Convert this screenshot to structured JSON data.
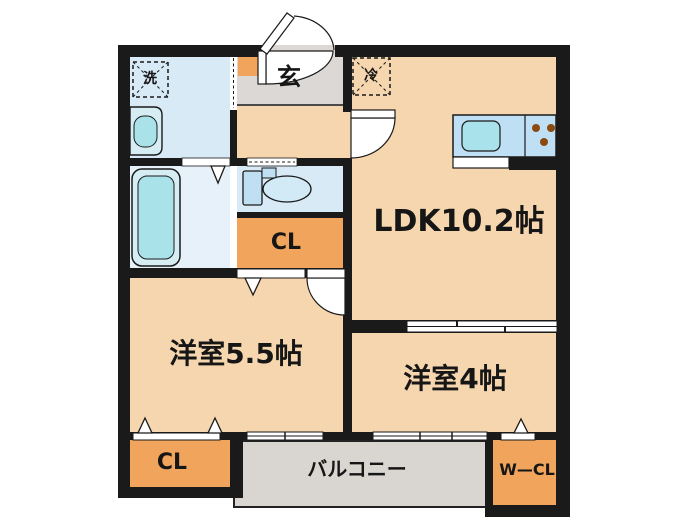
{
  "type": "floorplan",
  "palette": {
    "wall": "#1a1a1a",
    "room_beige": "#F5D6AE",
    "closet_orange": "#F0A45C",
    "wet_area_blue": "#D9EAF7",
    "bath_blue": "#E6F1FA",
    "fixture_cyan": "#A9E3E9",
    "kitchen_counter_blue": "#BFDFF4",
    "entrance_gray": "#DBD8D5",
    "balcony_gray": "#D9D5D1",
    "burner_brown": "#8B4A10",
    "background": "#FFFFFF"
  },
  "rooms": {
    "ldk": {
      "label": "LDK10.2帖"
    },
    "western_room_5_5": {
      "label": "洋室5.5帖"
    },
    "western_room_4": {
      "label": "洋室4帖"
    },
    "closet_hall": {
      "label": "CL"
    },
    "closet_bedroom": {
      "label": "CL"
    },
    "walk_in_closet": {
      "label": "W—CL"
    },
    "balcony": {
      "label": "バルコニー"
    },
    "entrance": {
      "label": "玄"
    }
  },
  "fixtures": {
    "washer": {
      "label": "洗"
    },
    "refrigerator": {
      "label": "冷"
    }
  }
}
